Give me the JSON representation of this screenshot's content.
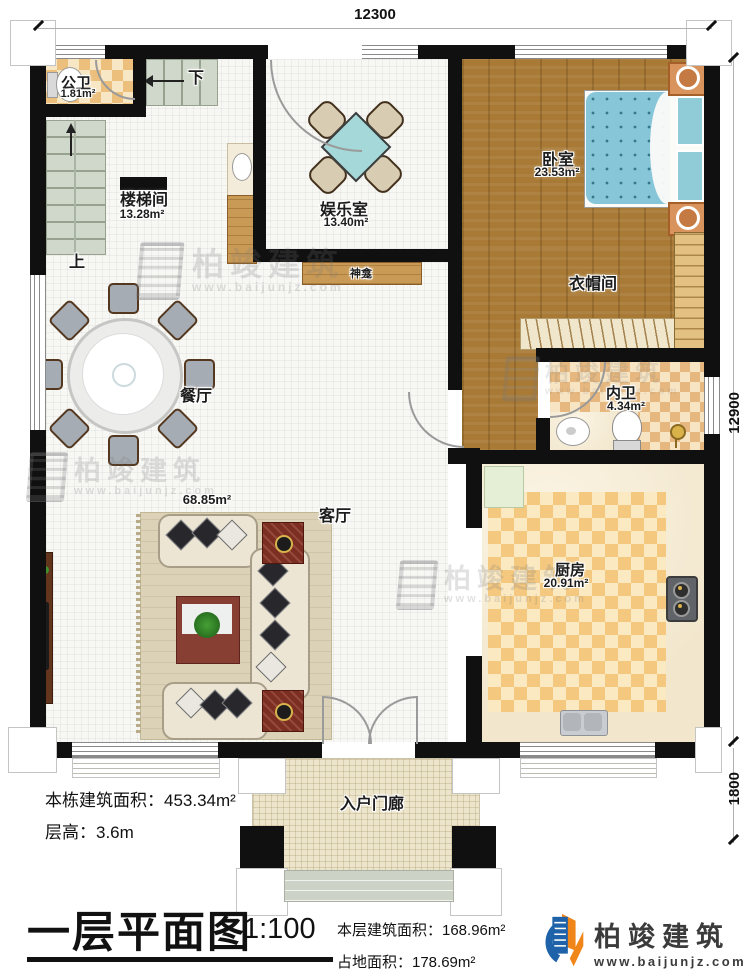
{
  "dimensions": {
    "top_width": "12300",
    "right_height": "12900",
    "porch_height": "1800"
  },
  "rooms": {
    "gongwei": {
      "name": "公卫",
      "area": "1.81m²"
    },
    "loutijian": {
      "name": "楼梯间",
      "area": "13.28m²"
    },
    "yuleshi": {
      "name": "娱乐室",
      "area": "13.40m²"
    },
    "woshi": {
      "name": "卧室",
      "area": "23.53m²"
    },
    "yimaojian": {
      "name": "衣帽间"
    },
    "neiwei": {
      "name": "内卫",
      "area": "4.34m²"
    },
    "canting": {
      "name": "餐厅"
    },
    "keting": {
      "name": "客厅",
      "area": "68.85m²"
    },
    "chufang": {
      "name": "厨房",
      "area": "20.91m²"
    },
    "menlang": {
      "name": "入户门廊"
    },
    "shenkan": {
      "name": "神龛"
    }
  },
  "stairs": {
    "up": "上",
    "down": "下"
  },
  "footer": {
    "building_area": "本栋建筑面积：453.34m²",
    "floor_height": "层高：3.6m",
    "title": "一层平面图",
    "scale": "1:100",
    "floor_area": "本层建筑面积：168.96m²",
    "footprint_area": "占地面积：178.69m²"
  },
  "brand": {
    "name": "柏竣建筑",
    "url": "www.baijunjz.com"
  },
  "watermark": {
    "name": "柏竣建筑",
    "url": "www.baijunjz.com"
  },
  "colors": {
    "wall": "#101010",
    "wood": "#a87a36",
    "bath_tile": "#e6b87f",
    "stairs": "#ccd5c7",
    "porch": "#ece5cb",
    "bed": "#8cc8da",
    "logo_blue": "#1e62a9",
    "logo_orange": "#f08519"
  }
}
